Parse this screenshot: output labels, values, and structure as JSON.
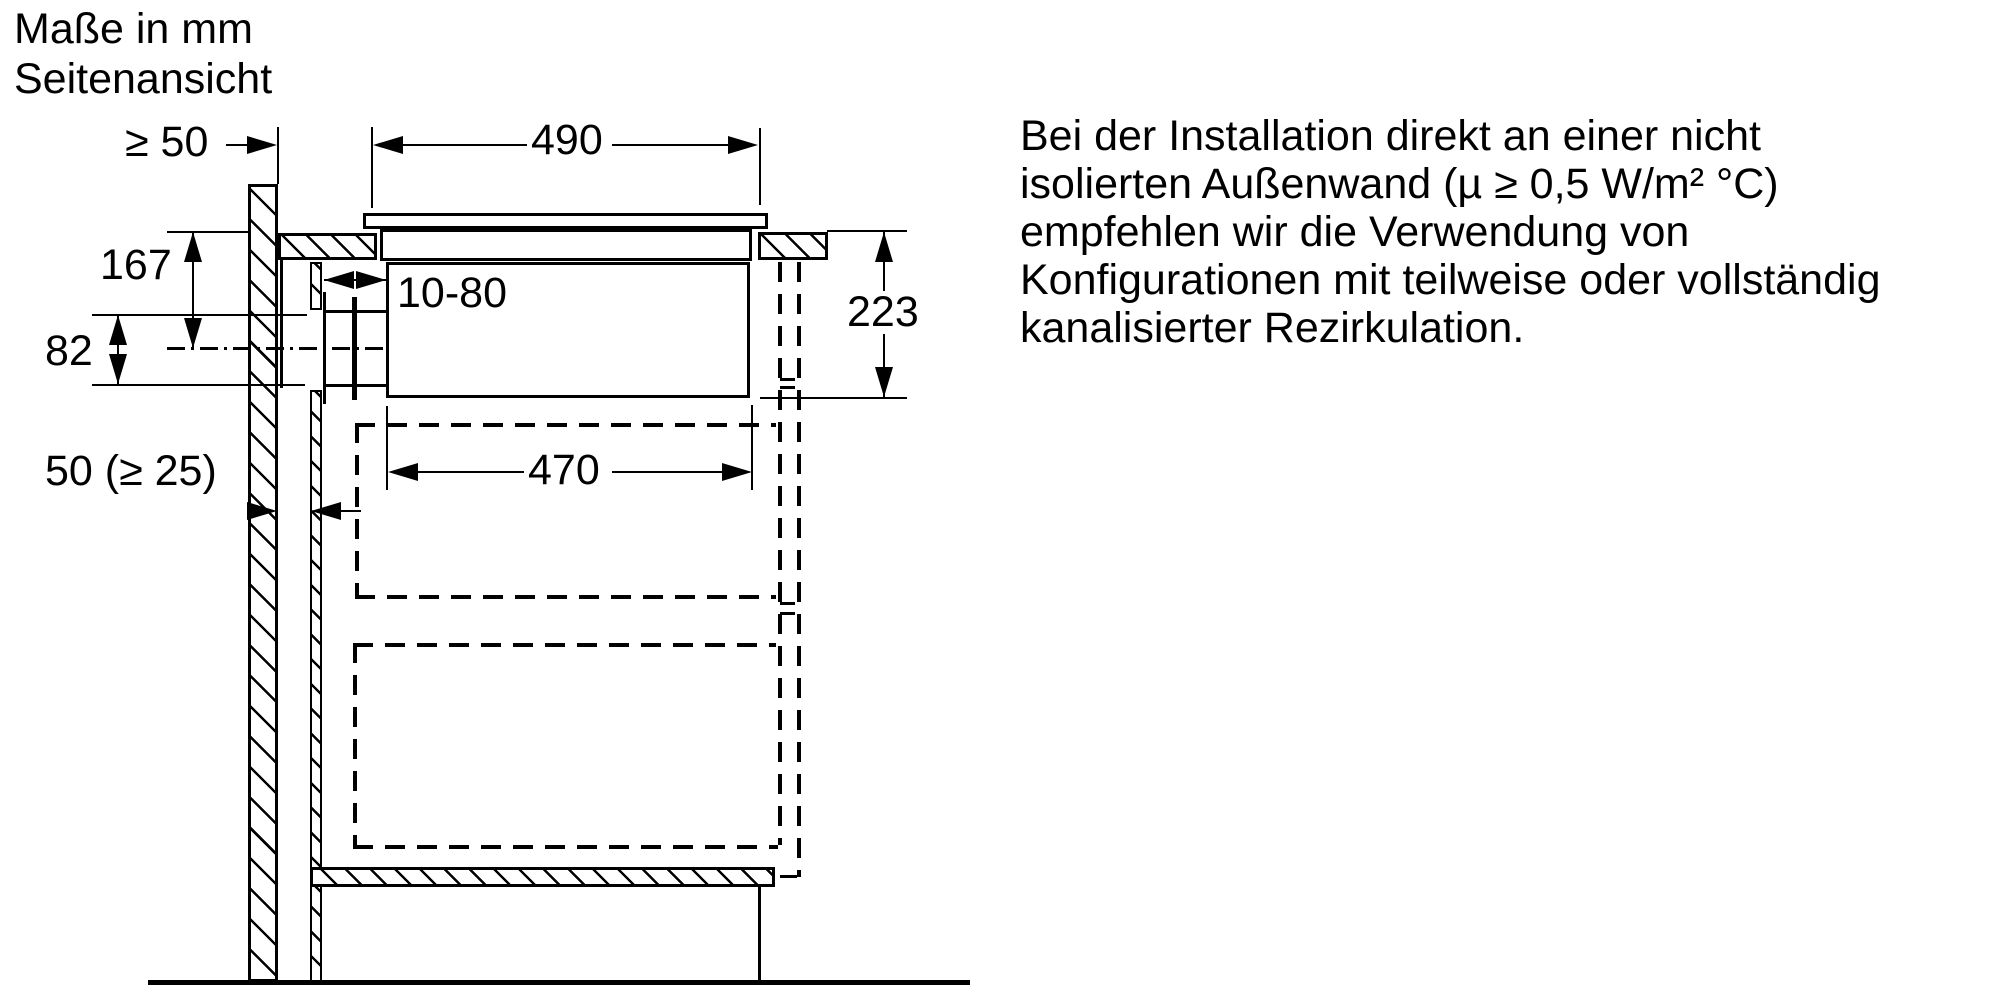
{
  "header": {
    "title_line1": "Maße in mm",
    "title_line2": "Seitenansicht"
  },
  "dimensions": {
    "wall_clearance": "≥ 50",
    "cutout_width": "490",
    "worktop_to_duct_center": "167",
    "duct_height": "82",
    "duct_slide_range": "10-80",
    "rear_gap": "50 (≥ 25)",
    "appliance_box_width": "470",
    "appliance_box_depth": "223"
  },
  "note": {
    "lines": [
      "Bei der Installation direkt an einer nicht",
      "isolierten Außenwand (µ ≥ 0,5 W/m² °C)",
      "empfehlen wir die Verwendung von",
      "Konfigurationen mit teilweise oder vollständig",
      "kanalisierter Rezirkulation."
    ]
  },
  "colors": {
    "ink": "#000000",
    "background": "#ffffff"
  }
}
